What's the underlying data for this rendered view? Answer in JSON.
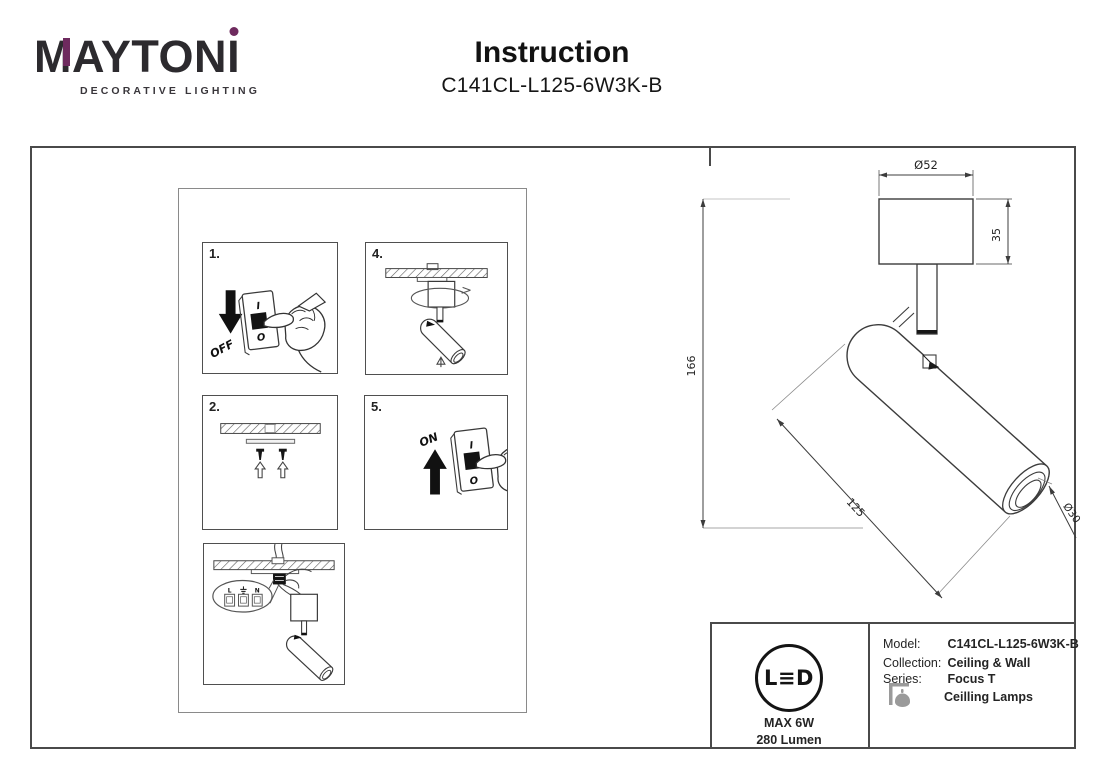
{
  "brand": {
    "name_m": "M",
    "name_rest": "AYTON",
    "name_i": "I",
    "tagline": "DECORATIVE LIGHTING",
    "accent_color": "#6e2a5e"
  },
  "header": {
    "title": "Instruction",
    "model": "C141CL-L125-6W3K-B"
  },
  "steps": {
    "one": {
      "number": "1.",
      "switch_top": "I",
      "switch_bottom": "O",
      "action": "OFF"
    },
    "two": {
      "number": "2."
    },
    "three": {
      "terminal_left": "L",
      "terminal_middle_icon": "earth-ground-icon",
      "terminal_right": "N"
    },
    "four": {
      "number": "4."
    },
    "five": {
      "number": "5.",
      "switch_top": "I",
      "switch_bottom": "O",
      "action": "ON"
    }
  },
  "dimensions": {
    "canopy_diameter": "Ø52",
    "canopy_height": "35",
    "total_height": "166",
    "tube_length": "125",
    "tube_diameter": "Ø30"
  },
  "spec": {
    "led_logo": "L≡D",
    "max_power": "MAX 6W",
    "luminous_flux": "280 Lumen",
    "model_label": "Model:",
    "model_value": "C141CL-L125-6W3K-B",
    "collection_label": "Collection:",
    "collection_value": "Ceiling & Wall",
    "series_label": "Series:",
    "series_value": "Focus T",
    "series_value2": "Ceilling Lamps"
  }
}
